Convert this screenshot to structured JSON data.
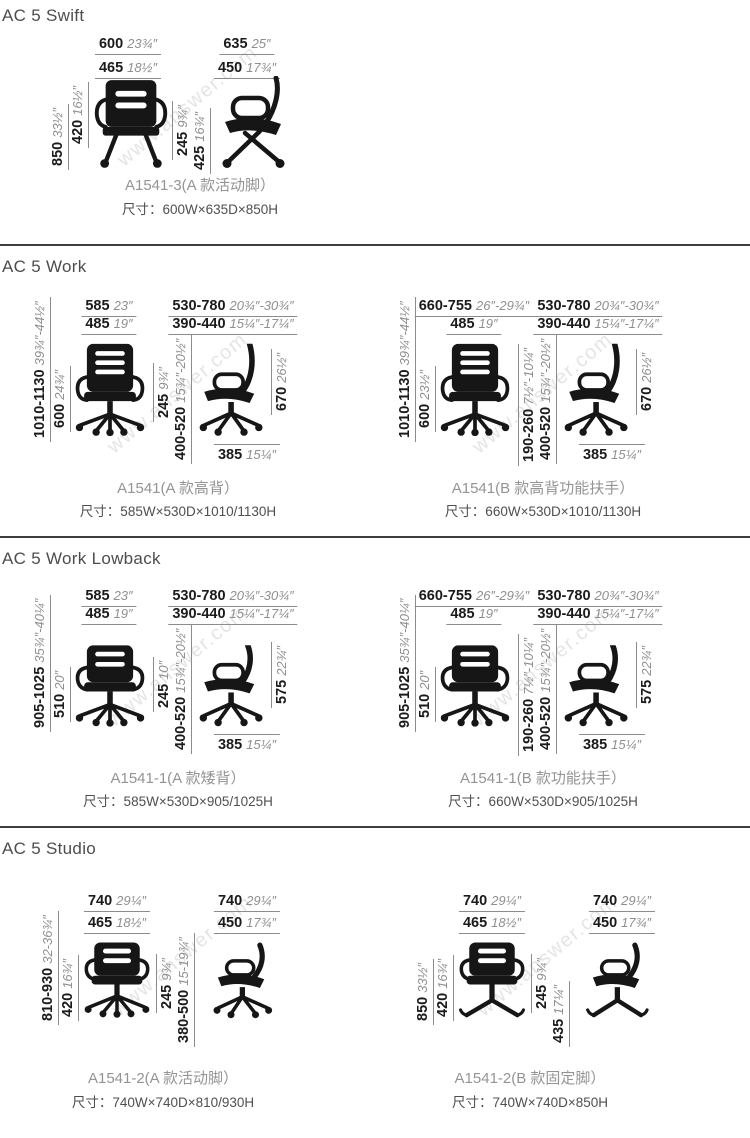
{
  "watermark": {
    "text": "www.answer.com"
  },
  "sections": [
    {
      "title": "AC 5 Swift",
      "groups": [
        {
          "caption": "A1541-3(A 款活动脚）",
          "size": "尺寸：600W×635D×850H",
          "front_top1": {
            "mm": "600",
            "in": "23¾″"
          },
          "front_top2": {
            "mm": "465",
            "in": "18½″"
          },
          "front_left1": {
            "mm": "850",
            "in": "33½″"
          },
          "front_left2": {
            "mm": "420",
            "in": "16½″"
          },
          "mid1": {
            "mm": "245",
            "in": "9¾″"
          },
          "mid2": {
            "mm": "425",
            "in": "16¾″"
          },
          "side_top1": {
            "mm": "635",
            "in": "25″"
          },
          "side_top2": {
            "mm": "450",
            "in": "17¾″"
          }
        }
      ]
    },
    {
      "title": "AC 5 Work",
      "groups": [
        {
          "caption": "A1541(A 款高背）",
          "size": "尺寸：585W×530D×1010/1130H",
          "front_top1": {
            "mm": "585",
            "in": "23″"
          },
          "front_top2": {
            "mm": "485",
            "in": "19″"
          },
          "front_left1": {
            "mm": "1010-1130",
            "in": "39¾″-44½″"
          },
          "front_left2": {
            "mm": "600",
            "in": "24¾″"
          },
          "mid1": {
            "mm": "245",
            "in": "9¾″"
          },
          "mid2": {
            "mm": "400-520",
            "in": "15¾″-20½″"
          },
          "side_top1": {
            "mm": "530-780",
            "in": "20¾″-30¾″"
          },
          "side_top2": {
            "mm": "390-440",
            "in": "15¼″-17¼″"
          },
          "side_right": {
            "mm": "670",
            "in": "26½″"
          },
          "side_bottom": {
            "mm": "385",
            "in": "15¼″"
          }
        },
        {
          "caption": "A1541(B 款高背功能扶手）",
          "size": "尺寸：660W×530D×1010/1130H",
          "front_top1": {
            "mm": "660-755",
            "in": "26″-29¾″"
          },
          "front_top2": {
            "mm": "485",
            "in": "19″"
          },
          "front_left1": {
            "mm": "1010-1130",
            "in": "39¾″-44½″"
          },
          "front_left2": {
            "mm": "600",
            "in": "23½″"
          },
          "mid1": {
            "mm": "190-260",
            "in": "7½″-10¼″"
          },
          "mid2": {
            "mm": "400-520",
            "in": "15¾″-20½″"
          },
          "side_top1": {
            "mm": "530-780",
            "in": "20¾″-30¾″"
          },
          "side_top2": {
            "mm": "390-440",
            "in": "15¼″-17¼″"
          },
          "side_right": {
            "mm": "670",
            "in": "26½″"
          },
          "side_bottom": {
            "mm": "385",
            "in": "15¼″"
          }
        }
      ]
    },
    {
      "title": "AC 5 Work Lowback",
      "groups": [
        {
          "caption": "A1541-1(A 款矮背）",
          "size": "尺寸：585W×530D×905/1025H",
          "front_top1": {
            "mm": "585",
            "in": "23″"
          },
          "front_top2": {
            "mm": "485",
            "in": "19″"
          },
          "front_left1": {
            "mm": "905-1025",
            "in": "35¾″-40¼″"
          },
          "front_left2": {
            "mm": "510",
            "in": "20″"
          },
          "mid1": {
            "mm": "245",
            "in": "10″"
          },
          "mid2": {
            "mm": "400-520",
            "in": "15¾″-20½″"
          },
          "side_top1": {
            "mm": "530-780",
            "in": "20¾″-30¾″"
          },
          "side_top2": {
            "mm": "390-440",
            "in": "15¼″-17¼″"
          },
          "side_right": {
            "mm": "575",
            "in": "22¾″"
          },
          "side_bottom": {
            "mm": "385",
            "in": "15¼″"
          }
        },
        {
          "caption": "A1541-1(B 款功能扶手）",
          "size": "尺寸：660W×530D×905/1025H",
          "front_top1": {
            "mm": "660-755",
            "in": "26″-29¾″"
          },
          "front_top2": {
            "mm": "485",
            "in": "19″"
          },
          "front_left1": {
            "mm": "905-1025",
            "in": "35¾″-40¼″"
          },
          "front_left2": {
            "mm": "510",
            "in": "20″"
          },
          "mid1": {
            "mm": "190-260",
            "in": "7½″-10¼″"
          },
          "mid2": {
            "mm": "400-520",
            "in": "15¾″-20½″"
          },
          "side_top1": {
            "mm": "530-780",
            "in": "20¾″-30¾″"
          },
          "side_top2": {
            "mm": "390-440",
            "in": "15¼″-17¼″"
          },
          "side_right": {
            "mm": "575",
            "in": "22¾″"
          },
          "side_bottom": {
            "mm": "385",
            "in": "15¼″"
          }
        }
      ]
    },
    {
      "title": "AC 5 Studio",
      "groups": [
        {
          "caption": "A1541-2(A 款活动脚）",
          "size": "尺寸：740W×740D×810/930H",
          "front_top1": {
            "mm": "740",
            "in": "29¼″"
          },
          "front_top2": {
            "mm": "465",
            "in": "18½″"
          },
          "front_left1": {
            "mm": "810-930",
            "in": "32-36¾″"
          },
          "front_left2": {
            "mm": "420",
            "in": "16¾″"
          },
          "mid1": {
            "mm": "245",
            "in": "9¾″"
          },
          "mid2": {
            "mm": "380-500",
            "in": "15-19¾″"
          },
          "side_top1": {
            "mm": "740",
            "in": "29¼″"
          },
          "side_top2": {
            "mm": "450",
            "in": "17¾″"
          }
        },
        {
          "caption": "A1541-2(B 款固定脚）",
          "size": "尺寸：740W×740D×850H",
          "front_top1": {
            "mm": "740",
            "in": "29¼″"
          },
          "front_top2": {
            "mm": "465",
            "in": "18½″"
          },
          "front_left1": {
            "mm": "850",
            "in": "33½″"
          },
          "front_left2": {
            "mm": "420",
            "in": "16¾″"
          },
          "mid1": {
            "mm": "245",
            "in": "9¾″"
          },
          "mid2": {
            "mm": "435",
            "in": "17¼″"
          },
          "side_top1": {
            "mm": "740",
            "in": "29¼″"
          },
          "side_top2": {
            "mm": "450",
            "in": "17¾″"
          }
        }
      ]
    }
  ]
}
